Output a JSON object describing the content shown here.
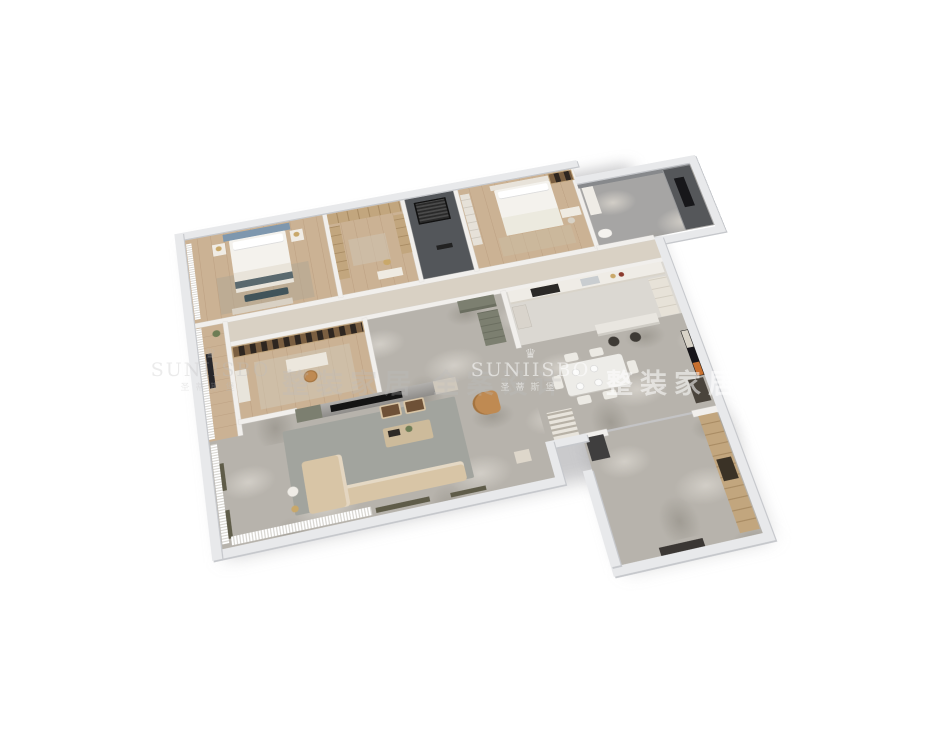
{
  "watermark": {
    "brand_en": "SUNIISBO",
    "brand_cn": "圣蒂斯堡",
    "tagline": "整装家居 全案设计",
    "crown_icon": "♛"
  },
  "colors": {
    "background": "#ffffff",
    "outer_wall": "#e8e9eb",
    "wall_edge": "#c6c8cc",
    "inner_wall": "#f1efec",
    "marble_floor": "#b7b3ac",
    "marble_light": "#d2cec7",
    "marble_dark": "#a09c94",
    "tile_floor": "#dbd8d2",
    "wood_floor": "#cbb294",
    "wood_dark": "#bda183",
    "dark_room": "#53565a",
    "bath_floor": "#a6a5a4",
    "shower_dark": "#55575a",
    "sofa": "#d8c5a6",
    "armchair": "#bf8a52",
    "rug": "#a2a49e",
    "coffee_table": "#cdbb9b",
    "tv_screen": "#141414",
    "cabinet_green": "#7c7f70",
    "dining_table": "#edece8",
    "chair_white": "#eceae4",
    "stool_dark": "#3e3a35",
    "counter": "#efece6",
    "cooktop": "#2b2927",
    "wardrobe_wood": "#c2a67e",
    "wardrobe_line": "#a98c64",
    "shelf_wood": "#7b5f41",
    "shelf_dark": "#2e2620",
    "bed_blue": "#7e97ae",
    "bedding": "#f4f2ed",
    "pillow": "#ffffff",
    "blanket": "#e9e4da",
    "bench_teal": "#41545a",
    "curtain_shade": "#d8d6d1",
    "sill_olive": "#5f5c49",
    "door_dark": "#3b3734",
    "art_orange": "#c8702f",
    "art_frame": "#17151a",
    "lamp_gold": "#c9a86a",
    "plant_green": "#6d7d55",
    "watermark_gray": "rgba(190,190,188,0.30)",
    "watermark_white": "rgba(255,255,255,0.55)"
  }
}
